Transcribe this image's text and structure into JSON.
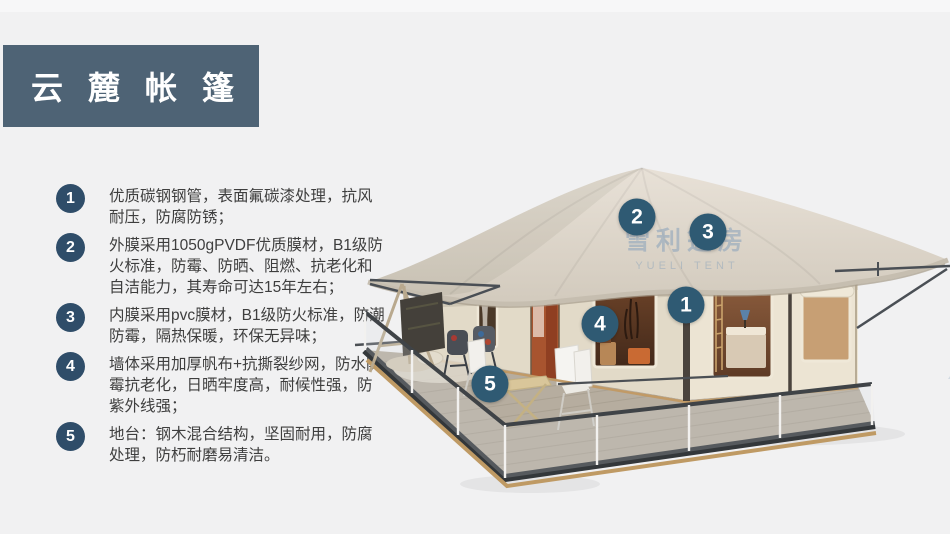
{
  "title": {
    "text": "云麓帐篷"
  },
  "features": [
    {
      "num": "1",
      "text": "优质碳钢钢管，表面氟碳漆处理，抗风耐压，防腐防锈；"
    },
    {
      "num": "2",
      "text": "外膜采用1050gPVDF优质膜材，B1级防火标准，防霉、防晒、阻燃、抗老化和自洁能力，其寿命可达15年左右；"
    },
    {
      "num": "3",
      "text": "内膜采用pvc膜材，B1级防火标准，防潮防霉，隔热保暖，环保无异味；"
    },
    {
      "num": "4",
      "text": "墙体采用加厚帆布+抗撕裂纱网，防水防霉抗老化，日晒牢度高，耐候性强，防紫外线强；"
    },
    {
      "num": "5",
      "text": "地台：钢木混合结构，坚固耐用，防腐处理，防朽耐磨易清洁。"
    }
  ],
  "diagram": {
    "markers": [
      {
        "num": "1",
        "x": 686,
        "y": 305
      },
      {
        "num": "2",
        "x": 637,
        "y": 217
      },
      {
        "num": "3",
        "x": 708,
        "y": 232
      },
      {
        "num": "4",
        "x": 600,
        "y": 324
      },
      {
        "num": "5",
        "x": 490,
        "y": 384
      }
    ],
    "watermark": {
      "cn": "雪利篷房",
      "en": "YUELI TENT"
    }
  },
  "colors": {
    "title_bg": "#4e6375",
    "badge": "#2f4d69",
    "marker": "#2f5a73",
    "canopy": "#d9d1c5",
    "wall": "#eae2d1",
    "deck": "#b6ad9f",
    "background": "#f1f1f2"
  }
}
